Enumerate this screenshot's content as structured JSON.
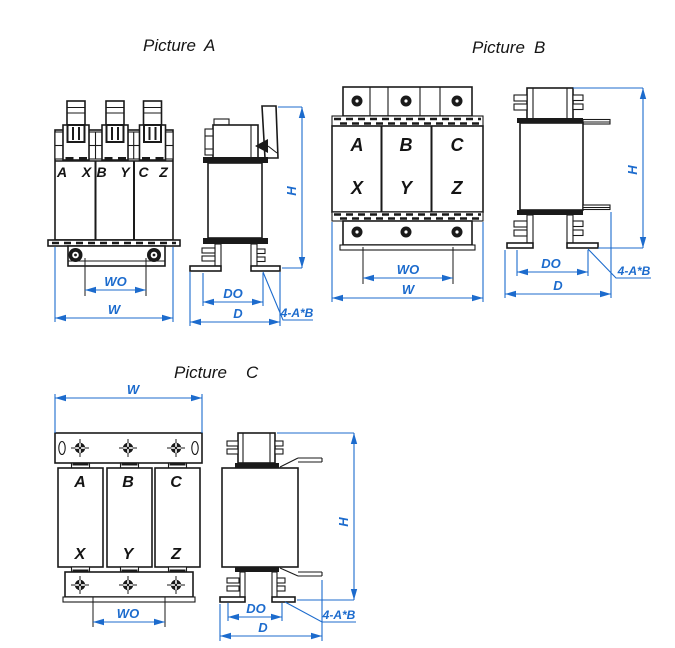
{
  "colors": {
    "line": "#1a1a1a",
    "dimension": "#1c6bcd",
    "background": "#ffffff"
  },
  "picture_a": {
    "title_word": "Picture",
    "title_letter": "A",
    "terminal_labels": [
      "A",
      "X",
      "B",
      "Y",
      "C",
      "Z"
    ],
    "dim_wo": "WO",
    "dim_w": "W",
    "dim_do": "DO",
    "dim_d": "D",
    "dim_h": "H",
    "dim_holes": "4-A*B"
  },
  "picture_b": {
    "title_word": "Picture",
    "title_letter": "B",
    "phase_labels_top": [
      "A",
      "B",
      "C"
    ],
    "phase_labels_bottom": [
      "X",
      "Y",
      "Z"
    ],
    "dim_wo": "WO",
    "dim_w": "W",
    "dim_do": "DO",
    "dim_d": "D",
    "dim_h": "H",
    "dim_holes": "4-A*B"
  },
  "picture_c": {
    "title_word": "Picture",
    "title_letter": "C",
    "phase_labels_top": [
      "A",
      "B",
      "C"
    ],
    "phase_labels_bottom": [
      "X",
      "Y",
      "Z"
    ],
    "dim_wo": "WO",
    "dim_w": "W",
    "dim_do": "DO",
    "dim_d": "D",
    "dim_h": "H",
    "dim_holes": "4-A*B"
  }
}
